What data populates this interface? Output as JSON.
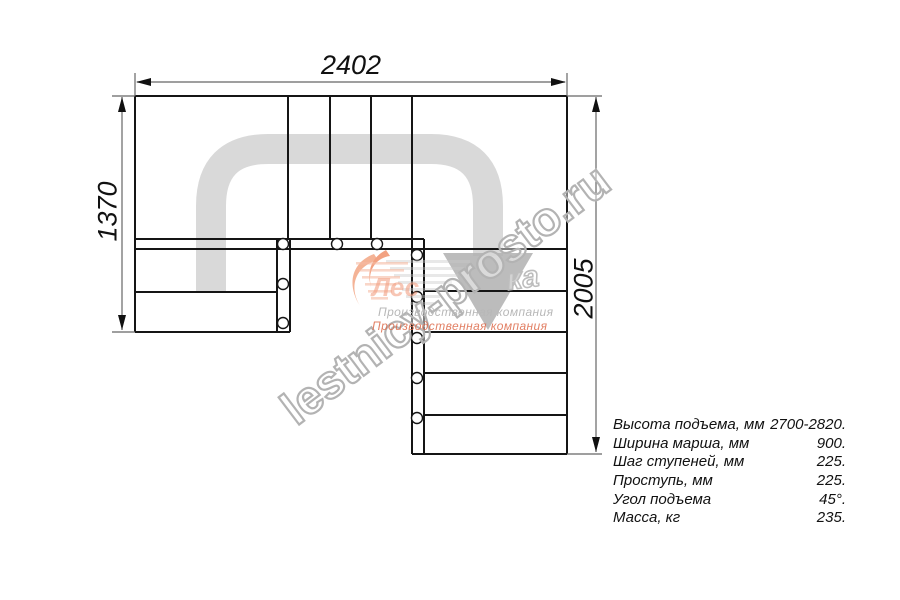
{
  "dimensions": {
    "width_top_mm": "2402",
    "height_left_mm": "1370",
    "height_right_mm": "2005"
  },
  "specs": {
    "rows": [
      {
        "label": "Высота подъема, мм",
        "value": "2700-2820."
      },
      {
        "label": "Ширина марша, мм",
        "value": "900."
      },
      {
        "label": "Шаг ступеней, мм",
        "value": "225."
      },
      {
        "label": "Проступь, мм",
        "value": "225."
      },
      {
        "label": "Угол подъема",
        "value": "45°."
      },
      {
        "label": "Масса, кг",
        "value": "235."
      }
    ]
  },
  "watermark": {
    "site": "lestnicy-prosto.ru",
    "ghost_fragment": "ка"
  },
  "logo": {
    "brand_fragment": "Лес",
    "tagline": "Производственная компания"
  },
  "colors": {
    "line": "#151515",
    "thin_line": "#666666",
    "walkline": "#d9d9d9",
    "walkline_arrow": "#b0b0b0",
    "watermark_gray": "#b3b3b3",
    "logo_orange": "#ef8a63"
  }
}
